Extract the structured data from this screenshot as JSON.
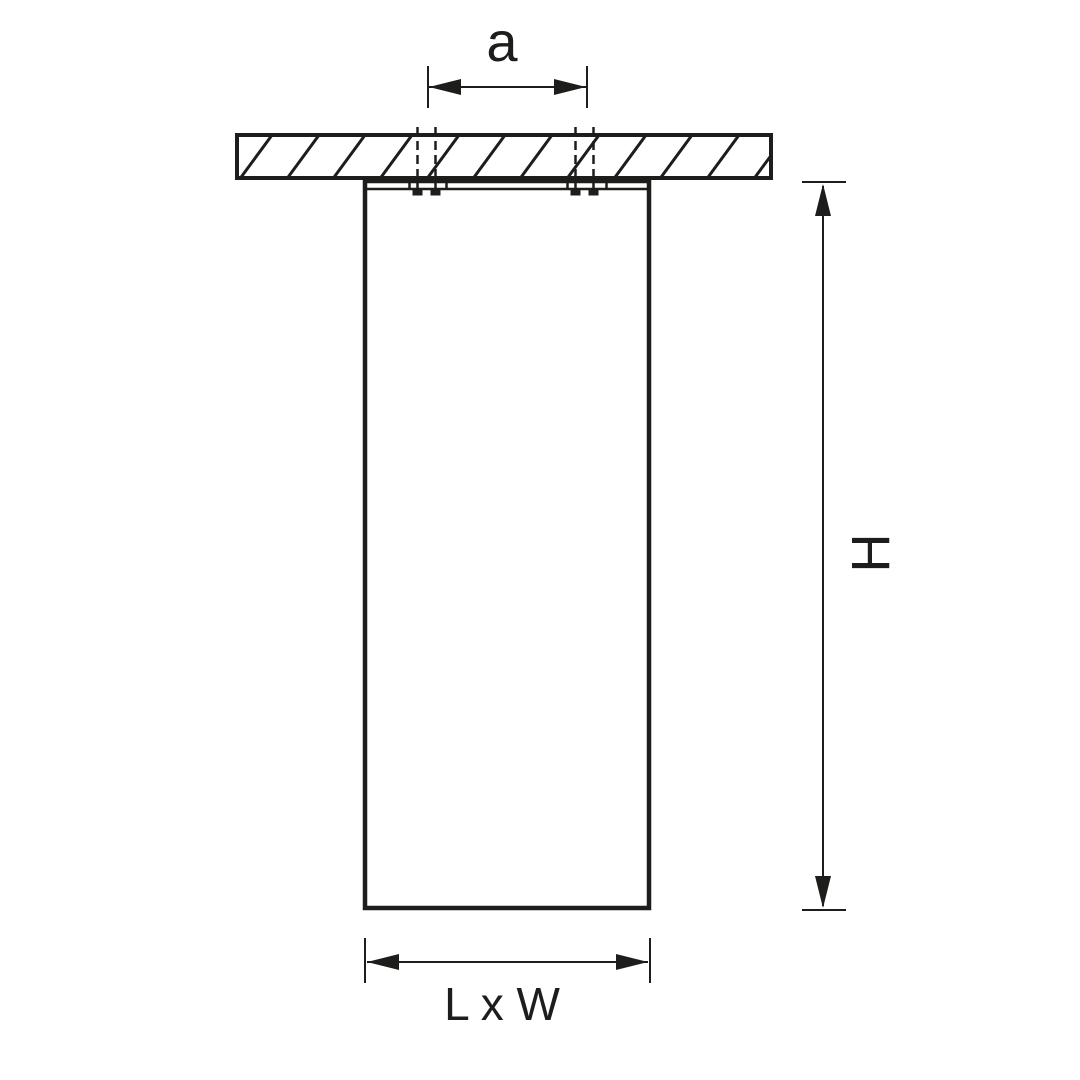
{
  "diagram": {
    "labels": {
      "hole_spacing": "a",
      "height": "H",
      "base": "L x W"
    },
    "colors": {
      "ink": "#1d1d1b",
      "background": "#ffffff"
    }
  }
}
